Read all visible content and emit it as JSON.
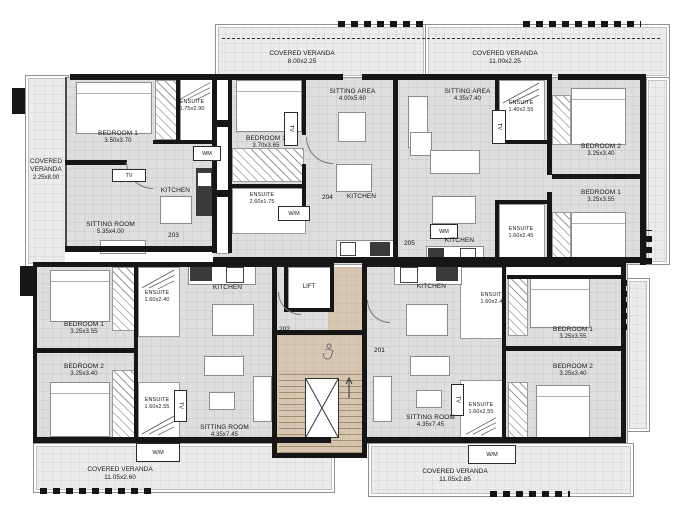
{
  "verandas": {
    "left": {
      "l1": "COVERED",
      "l2": "VERANDA",
      "dims": "2.25x8.00"
    },
    "top_middle": {
      "name": "COVERED VERANDA",
      "dims": "8.00x2.25"
    },
    "top_right": {
      "name": "COVERED VERANDA",
      "dims": "11.00x2.25"
    },
    "bottom_left": {
      "name": "COVERED VERANDA",
      "dims": "11.05x2.60"
    },
    "bottom_right": {
      "name": "COVERED VERANDA",
      "dims": "11.05x2.85"
    }
  },
  "units": {
    "u203": {
      "number": "203",
      "bedroom1": {
        "name": "BEDROOM 1",
        "dims": "3.50x3.70"
      },
      "ensuite": {
        "name": "ENSUITE",
        "dims": "1.75x2.90"
      },
      "sitting": {
        "name": "SITTING ROOM",
        "dims": "5.35x4.00"
      },
      "kitchen": "KITCHEN",
      "wm": "WM",
      "tv": "TV"
    },
    "u204": {
      "number": "204",
      "bedroom1": {
        "name": "BEDROOM 1",
        "dims": "3.70x3.65"
      },
      "ensuite": {
        "name": "ENSUITE",
        "dims": "2.60x1.75"
      },
      "sitting": {
        "name": "SITTING AREA",
        "dims": "4.00x5.60"
      },
      "kitchen": "KITCHEN",
      "wm": "W/M",
      "tv": "TV"
    },
    "u205": {
      "number": "205",
      "sitting": {
        "name": "SITTING AREA",
        "dims": "4.35x7.40"
      },
      "ensuite_top": {
        "name": "ENSUITE",
        "dims": "1.40x2.55"
      },
      "ensuite_bottom": {
        "name": "ENSUITE",
        "dims": "1.60x2.45"
      },
      "bedroom2": {
        "name": "BEDROOM 2",
        "dims": "3.25x3.40"
      },
      "bedroom1": {
        "name": "BEDROOM 1",
        "dims": "3.25x3.55"
      },
      "kitchen": "KITCHEN",
      "wm": "WM",
      "tv": "TV"
    },
    "u202": {
      "number": "202",
      "bedroom1": {
        "name": "BEDROOM 1",
        "dims": "3.25x3.55"
      },
      "bedroom2": {
        "name": "BEDROOM 2",
        "dims": "3.25x3.40"
      },
      "ensuite_top": {
        "name": "ENSUITE",
        "dims": "1.60x2.40"
      },
      "ensuite_bottom": {
        "name": "ENSUITE",
        "dims": "1.60x2.55"
      },
      "sitting": {
        "name": "SITTING ROOM",
        "dims": "4.35x7.45"
      },
      "kitchen": "KITCHEN",
      "wm": "W/M",
      "tv": "TV"
    },
    "u201": {
      "number": "201",
      "bedroom1": {
        "name": "BEDROOM 1",
        "dims": "3.25x3.55"
      },
      "bedroom2": {
        "name": "BEDROOM 2",
        "dims": "3.25x3.40"
      },
      "ensuite_top": {
        "name": "ENSUITE",
        "dims": "1.60x2.45"
      },
      "ensuite_bottom": {
        "name": "ENSUITE",
        "dims": "1.60x2.55"
      },
      "sitting": {
        "name": "SITTING ROOM",
        "dims": "4.35x7.45"
      },
      "kitchen": "KITCHEN",
      "wm": "W/M",
      "tv": "TV"
    }
  },
  "core": {
    "lift": "LIFT"
  },
  "colors": {
    "wall": "#161616",
    "room_fill": "#dedede",
    "veranda_fill": "#ececec",
    "core_fill": "#d8c7b0"
  }
}
